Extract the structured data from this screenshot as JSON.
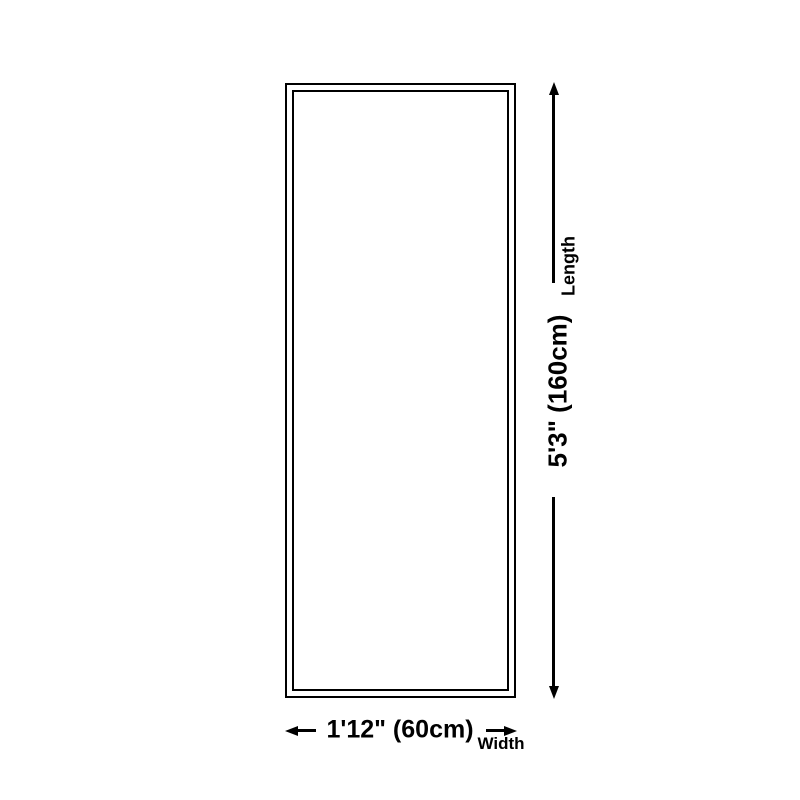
{
  "page": {
    "background_color": "#ffffff"
  },
  "diagram": {
    "type": "product-dimension-diagram",
    "shape": "rectangle-double-outline",
    "line_color": "#000000",
    "length": {
      "label": "Length",
      "value": "5'3\" (160cm)"
    },
    "width": {
      "label": "Width",
      "value": "1'12\" (60cm)"
    },
    "icons": {
      "up_arrow": "arrow-up",
      "down_arrow": "arrow-down",
      "left_arrow": "arrow-left",
      "right_arrow": "arrow-right"
    }
  }
}
